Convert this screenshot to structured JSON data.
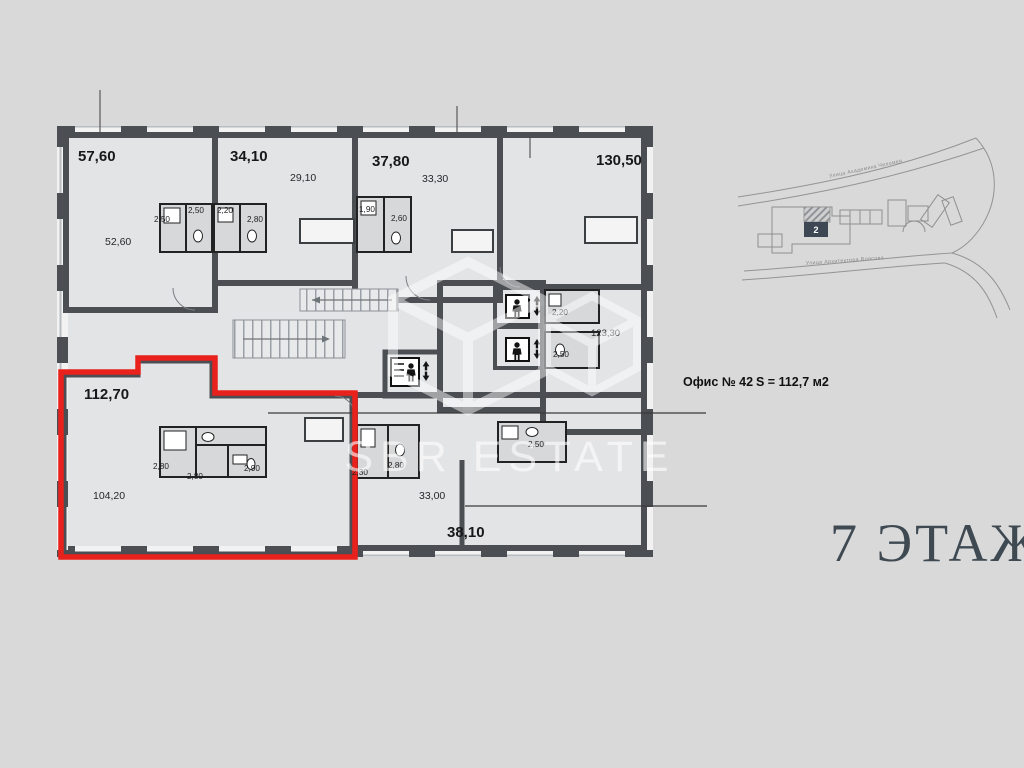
{
  "watermark": {
    "brand": "SBR ESTATE"
  },
  "floor_title": "7 ЭТАЖ",
  "callout": {
    "office": "Офис № 42",
    "area": "S = 112,7 м2"
  },
  "map": {
    "marker": "2",
    "street_top": "Улица Академика Челомея",
    "street_bottom": "Улица Архитектора Власова"
  },
  "rooms": {
    "r1": {
      "total": "57,60",
      "main": "52,60"
    },
    "r2": {
      "total": "34,10",
      "main": "29,10"
    },
    "r3": {
      "total": "37,80",
      "main": "33,30"
    },
    "r4": {
      "total": "130,50"
    },
    "r5": {
      "main": "123,30"
    },
    "office42": {
      "total": "112,70",
      "main": "104,20"
    },
    "r6": {
      "total": "38,10",
      "main": "33,00"
    }
  },
  "wet": {
    "a1": "2,50",
    "a2": "2,50",
    "b1": "2,20",
    "b2": "2,80",
    "c1": "1,90",
    "c2": "2,60",
    "e1": "2,80",
    "e2": "2,80",
    "e3": "2,90",
    "f1": "2,30",
    "f2": "2,80",
    "g1": "2,50",
    "h1": "2,20",
    "h2": "2,50"
  },
  "colors": {
    "background": "#d9d9d9",
    "room_fill": "#a7acb4",
    "corridor_fill": "#e3e4e6",
    "wall": "#4b4e52",
    "highlight_red": "#e8211c",
    "title_color": "#3e4952"
  }
}
